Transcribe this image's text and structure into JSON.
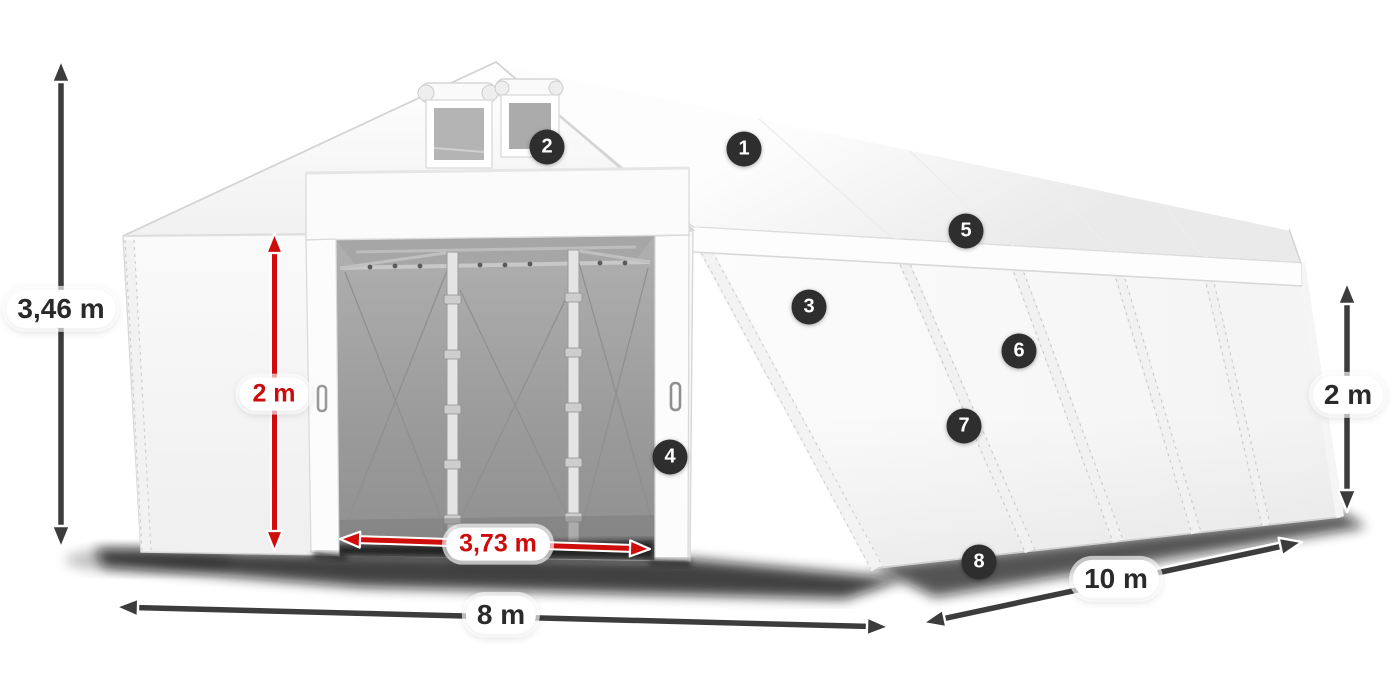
{
  "meta": {
    "description": "Isometric product diagram of a white storage tent (open front door) annotated with dimensions and numbered feature hotspots",
    "background": "#ffffff"
  },
  "colors": {
    "dimension_dark": "#3c3c3c",
    "dimension_red": "#cf0d0d",
    "badge_background": "#2e2e2e",
    "badge_text": "#ffffff",
    "label_background": "#ffffff",
    "label_text_dark": "#2a2a2a",
    "label_text_red": "#cc0c0c",
    "tent_white": "#ffffff",
    "interior_gray": "#9c9c9c"
  },
  "dims": {
    "total_height": {
      "label": "3,46 m",
      "style": "dark",
      "position": "left-vertical"
    },
    "door_height": {
      "label": "2 m",
      "style": "red",
      "position": "front-door-vertical"
    },
    "door_width": {
      "label": "3,73 m",
      "style": "red",
      "position": "front-door-base"
    },
    "front_width": {
      "label": "8 m",
      "style": "dark",
      "position": "front-base"
    },
    "side_length": {
      "label": "10 m",
      "style": "dark",
      "position": "side-base-diagonal"
    },
    "side_height": {
      "label": "2 m",
      "style": "dark",
      "position": "right-vertical"
    }
  },
  "badges": [
    {
      "number": "1"
    },
    {
      "number": "2"
    },
    {
      "number": "3"
    },
    {
      "number": "4"
    },
    {
      "number": "5"
    },
    {
      "number": "6"
    },
    {
      "number": "7"
    },
    {
      "number": "8"
    }
  ]
}
